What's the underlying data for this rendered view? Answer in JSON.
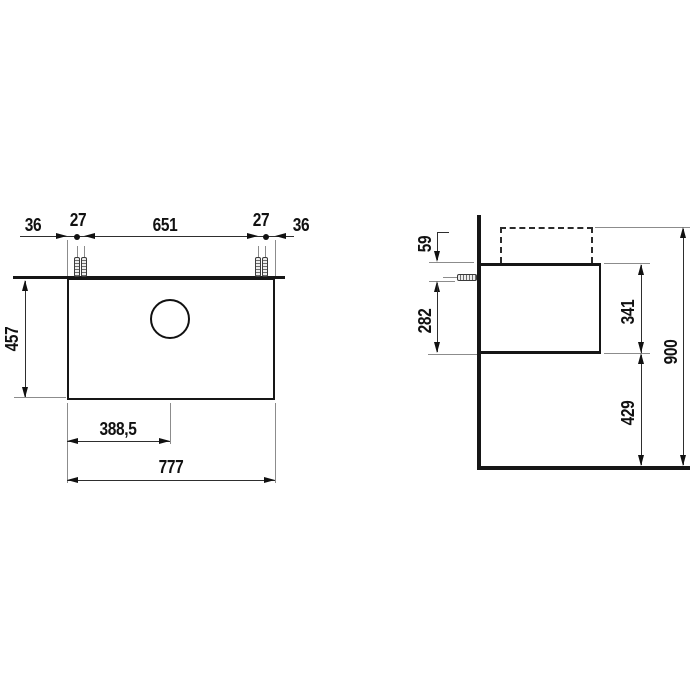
{
  "drawing": {
    "plan_view": {
      "dims": {
        "edge_to_screw_left": "36",
        "screw_pair_left": "27",
        "screw_span": "651",
        "screw_pair_right": "27",
        "edge_to_screw_right": "36",
        "depth": "457",
        "basin_center_offset": "388,5",
        "total_width": "777"
      }
    },
    "side_view": {
      "dims": {
        "top_to_anchor": "59",
        "anchor_to_bottom": "282",
        "cabinet_height": "341",
        "floor_clearance": "429",
        "total_height": "900"
      }
    },
    "colors": {
      "line": "#161616",
      "thin_line": "#8c8c8c",
      "background": "#ffffff"
    }
  }
}
